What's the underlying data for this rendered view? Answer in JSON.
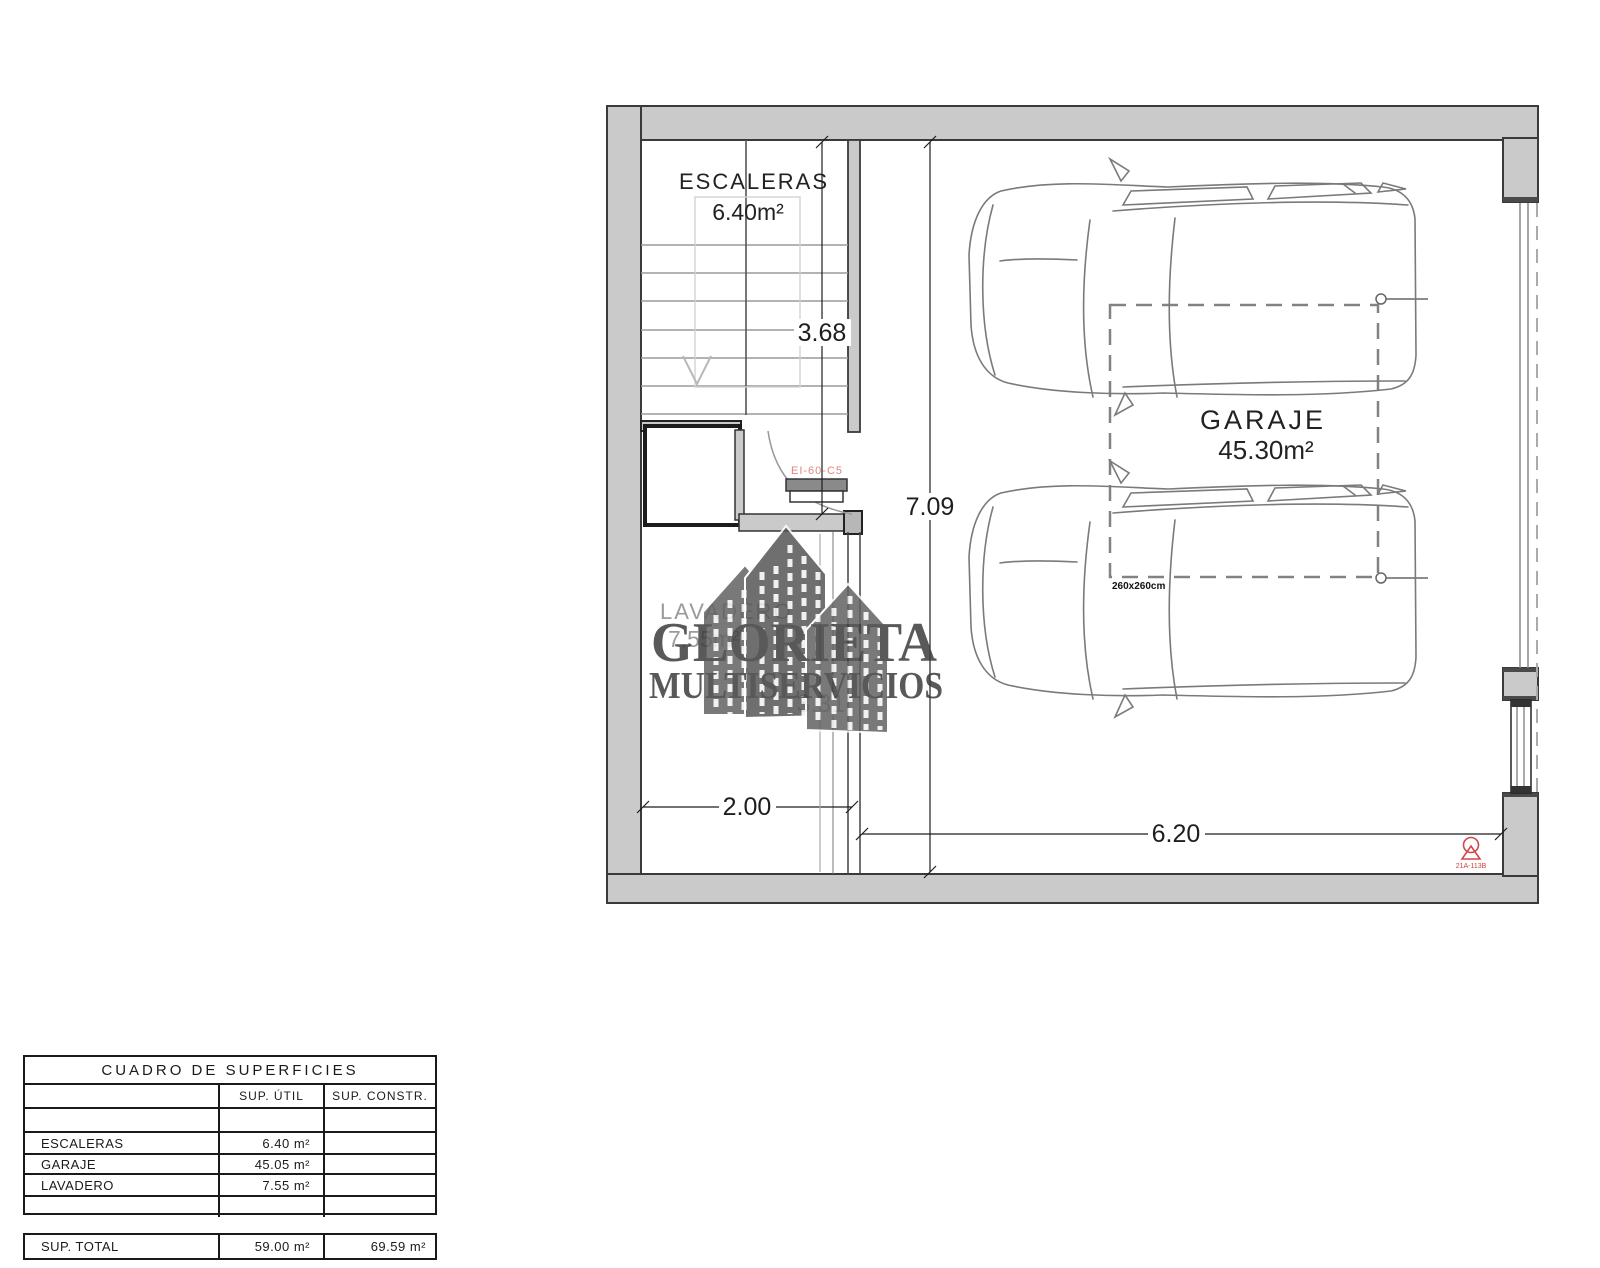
{
  "plan": {
    "rooms": {
      "stairs_label": "ESCALERAS",
      "stairs_area": "6.40m²",
      "garage_label": "GARAJE",
      "garage_area": "45.30m²",
      "laundry_label": "LAVADERO",
      "laundry_area": "7.55m²"
    },
    "dims": {
      "stairs_depth": "3.68",
      "garage_depth": "7.09",
      "laundry_width": "2.00",
      "garage_width": "6.20",
      "laundry_depth": "3.31",
      "parking_space": "260x260cm"
    },
    "door_label": "EI-60-C5",
    "extinguisher_label": "21A-113B"
  },
  "watermark": {
    "line1": "GLORIETA",
    "line2": "MULTISERVICIOS"
  },
  "table": {
    "title": "CUADRO DE SUPERFICIES",
    "col_util": "SUP. ÚTIL",
    "col_constr": "SUP. CONSTR.",
    "rows": [
      {
        "label": "ESCALERAS",
        "util": "6.40 m²",
        "constr": ""
      },
      {
        "label": "GARAJE",
        "util": "45.05 m²",
        "constr": ""
      },
      {
        "label": "LAVADERO",
        "util": "7.55 m²",
        "constr": ""
      }
    ],
    "total_label": "SUP. TOTAL",
    "total_util": "59.00 m²",
    "total_constr": "69.59 m²"
  },
  "colors": {
    "wall_fill": "#cacaca",
    "wall_edge": "#3a3a3a",
    "line_dark": "#222222",
    "car_line": "#7a7a7a",
    "fire_red": "#cc4444",
    "door_label_red": "#e08585",
    "watermark_gray": "#3d3d3d"
  }
}
